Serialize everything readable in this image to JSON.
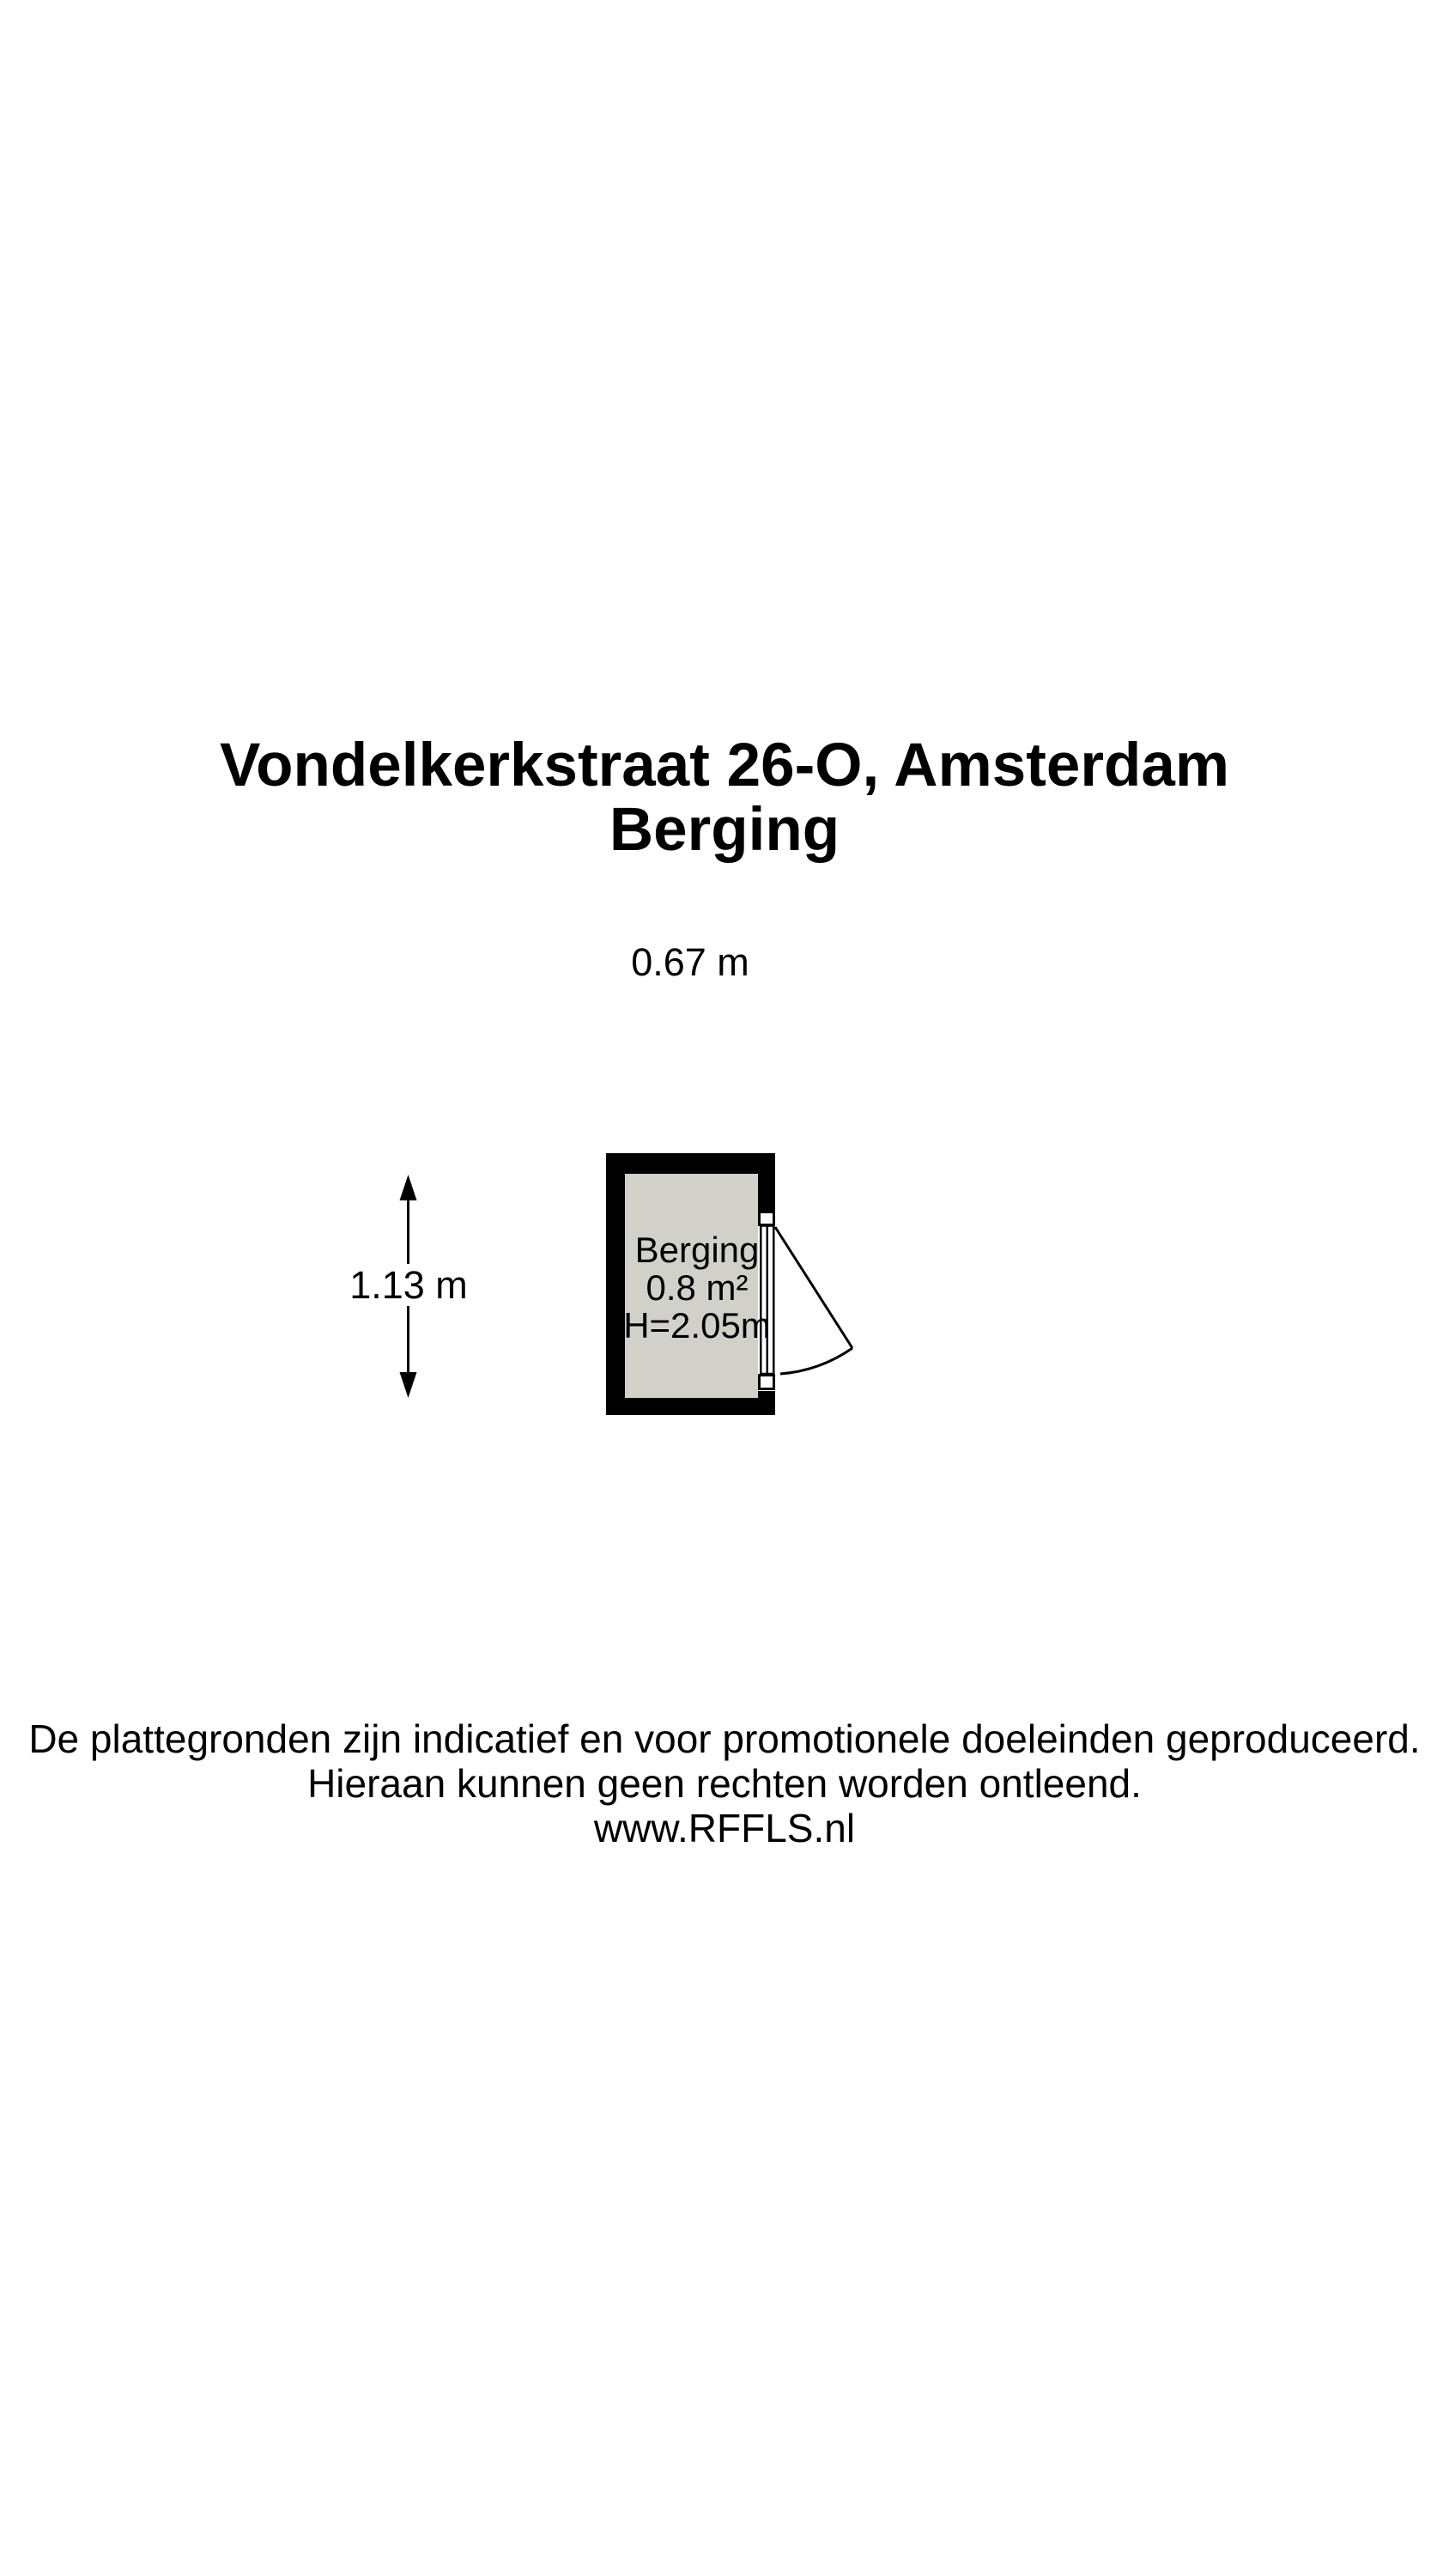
{
  "header": {
    "title": "Vondelkerkstraat 26-O, Amsterdam",
    "subtitle": "Berging"
  },
  "floorplan": {
    "room": {
      "name": "Berging",
      "area": "0.8 m²",
      "ceiling_height": "H=2.05m"
    },
    "dimensions": {
      "width_label": "0.67 m",
      "height_label": "1.13 m"
    },
    "colors": {
      "wall": "#000000",
      "floor": "#d1d1c9",
      "door": "#ffffff",
      "background": "#ffffff"
    }
  },
  "footer": {
    "line1": "De plattegronden zijn indicatief en voor promotionele doeleinden geproduceerd.",
    "line2": "Hieraan kunnen geen rechten worden ontleend.",
    "line3": "www.RFFLS.nl"
  }
}
